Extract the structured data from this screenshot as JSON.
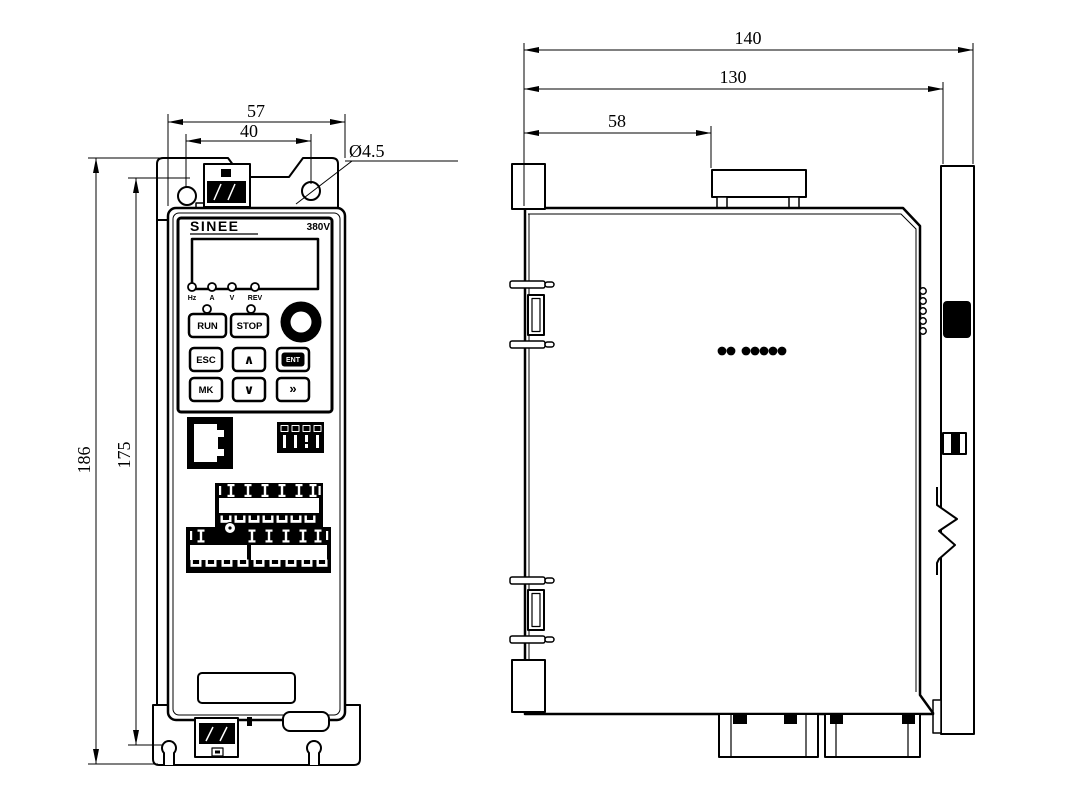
{
  "drawing": {
    "front_view": {
      "brand": "SINEE",
      "voltage": "380V",
      "indicator_leds": [
        "Hz",
        "A",
        "V",
        "REV"
      ],
      "buttons": {
        "run": "RUN",
        "stop": "STOP",
        "esc": "ESC",
        "up": "∧",
        "ent": "ENT",
        "mk": "MK",
        "down": "∨",
        "shift": "»"
      },
      "dimensions": {
        "outer_width": "57",
        "hole_spacing_width": "40",
        "hole_diameter": "Ø4.5",
        "outer_height": "186",
        "hole_spacing_height": "175"
      }
    },
    "side_view": {
      "dimensions": {
        "total_depth": "140",
        "body_depth": "130",
        "top_hook_offset": "58"
      }
    },
    "line_color": "#000000",
    "background": "#ffffff"
  }
}
